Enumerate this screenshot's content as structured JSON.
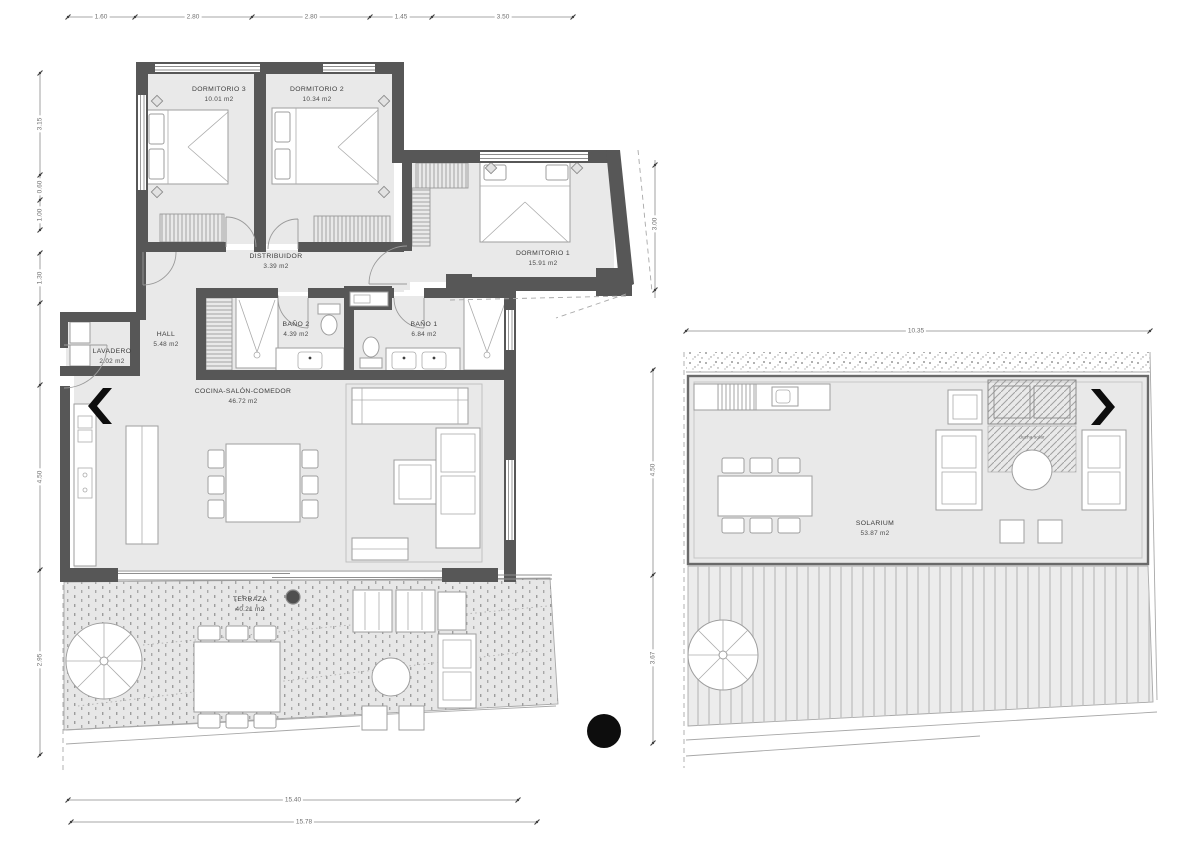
{
  "title": "apartment-floor-plan",
  "colors": {
    "wall": "#575757",
    "room_fill": "#e9e9e9",
    "deck_fill": "#e7e7e7",
    "line": "#9a9a9a",
    "marker_black": "#0d0d0d"
  },
  "main_floor": {
    "rooms": {
      "dormitorio3": {
        "name": "DORMITORIO 3",
        "area": "10.01 m2"
      },
      "dormitorio2": {
        "name": "DORMITORIO 2",
        "area": "10.34 m2"
      },
      "dormitorio1": {
        "name": "DORMITORIO 1",
        "area": "15.91 m2"
      },
      "distribuidor": {
        "name": "DISTRIBUIDOR",
        "area": "3.39 m2"
      },
      "hall": {
        "name": "HALL",
        "area": "5.48 m2"
      },
      "lavadero": {
        "name": "LAVADERO",
        "area": "2.02 m2"
      },
      "bano2": {
        "name": "BAÑO 2",
        "area": "4.39 m2"
      },
      "bano1": {
        "name": "BAÑO 1",
        "area": "6.84 m2"
      },
      "cocina_salon_comedor": {
        "name": "COCINA-SALÓN-COMEDOR",
        "area": "46.72 m2"
      },
      "terraza": {
        "name": "TERRAZA",
        "area": "40.21 m2"
      }
    },
    "dimensions": {
      "top": [
        "1.60",
        "2.80",
        "2.80",
        "1.45",
        "3.50"
      ],
      "left_upper": [
        "3.15",
        "0.60",
        "1.00"
      ],
      "left_lower": [
        "1.30",
        "4.50",
        "2.95"
      ],
      "right": [
        "3.00"
      ],
      "bottom": [
        "15.40",
        "15.78"
      ]
    }
  },
  "solarium_floor": {
    "rooms": {
      "solarium": {
        "name": "SOLARIUM",
        "area": "53.87 m2"
      }
    },
    "annotation": "ducha solar",
    "dimensions": {
      "top": [
        "10.35"
      ],
      "left": [
        "4.50",
        "3.67"
      ]
    }
  },
  "icons": {
    "entrance_arrow_main": "chevron-left",
    "entrance_arrow_solarium": "chevron-right",
    "section_marker": "black-dot",
    "terrace_marker": "small-dark-circle"
  }
}
